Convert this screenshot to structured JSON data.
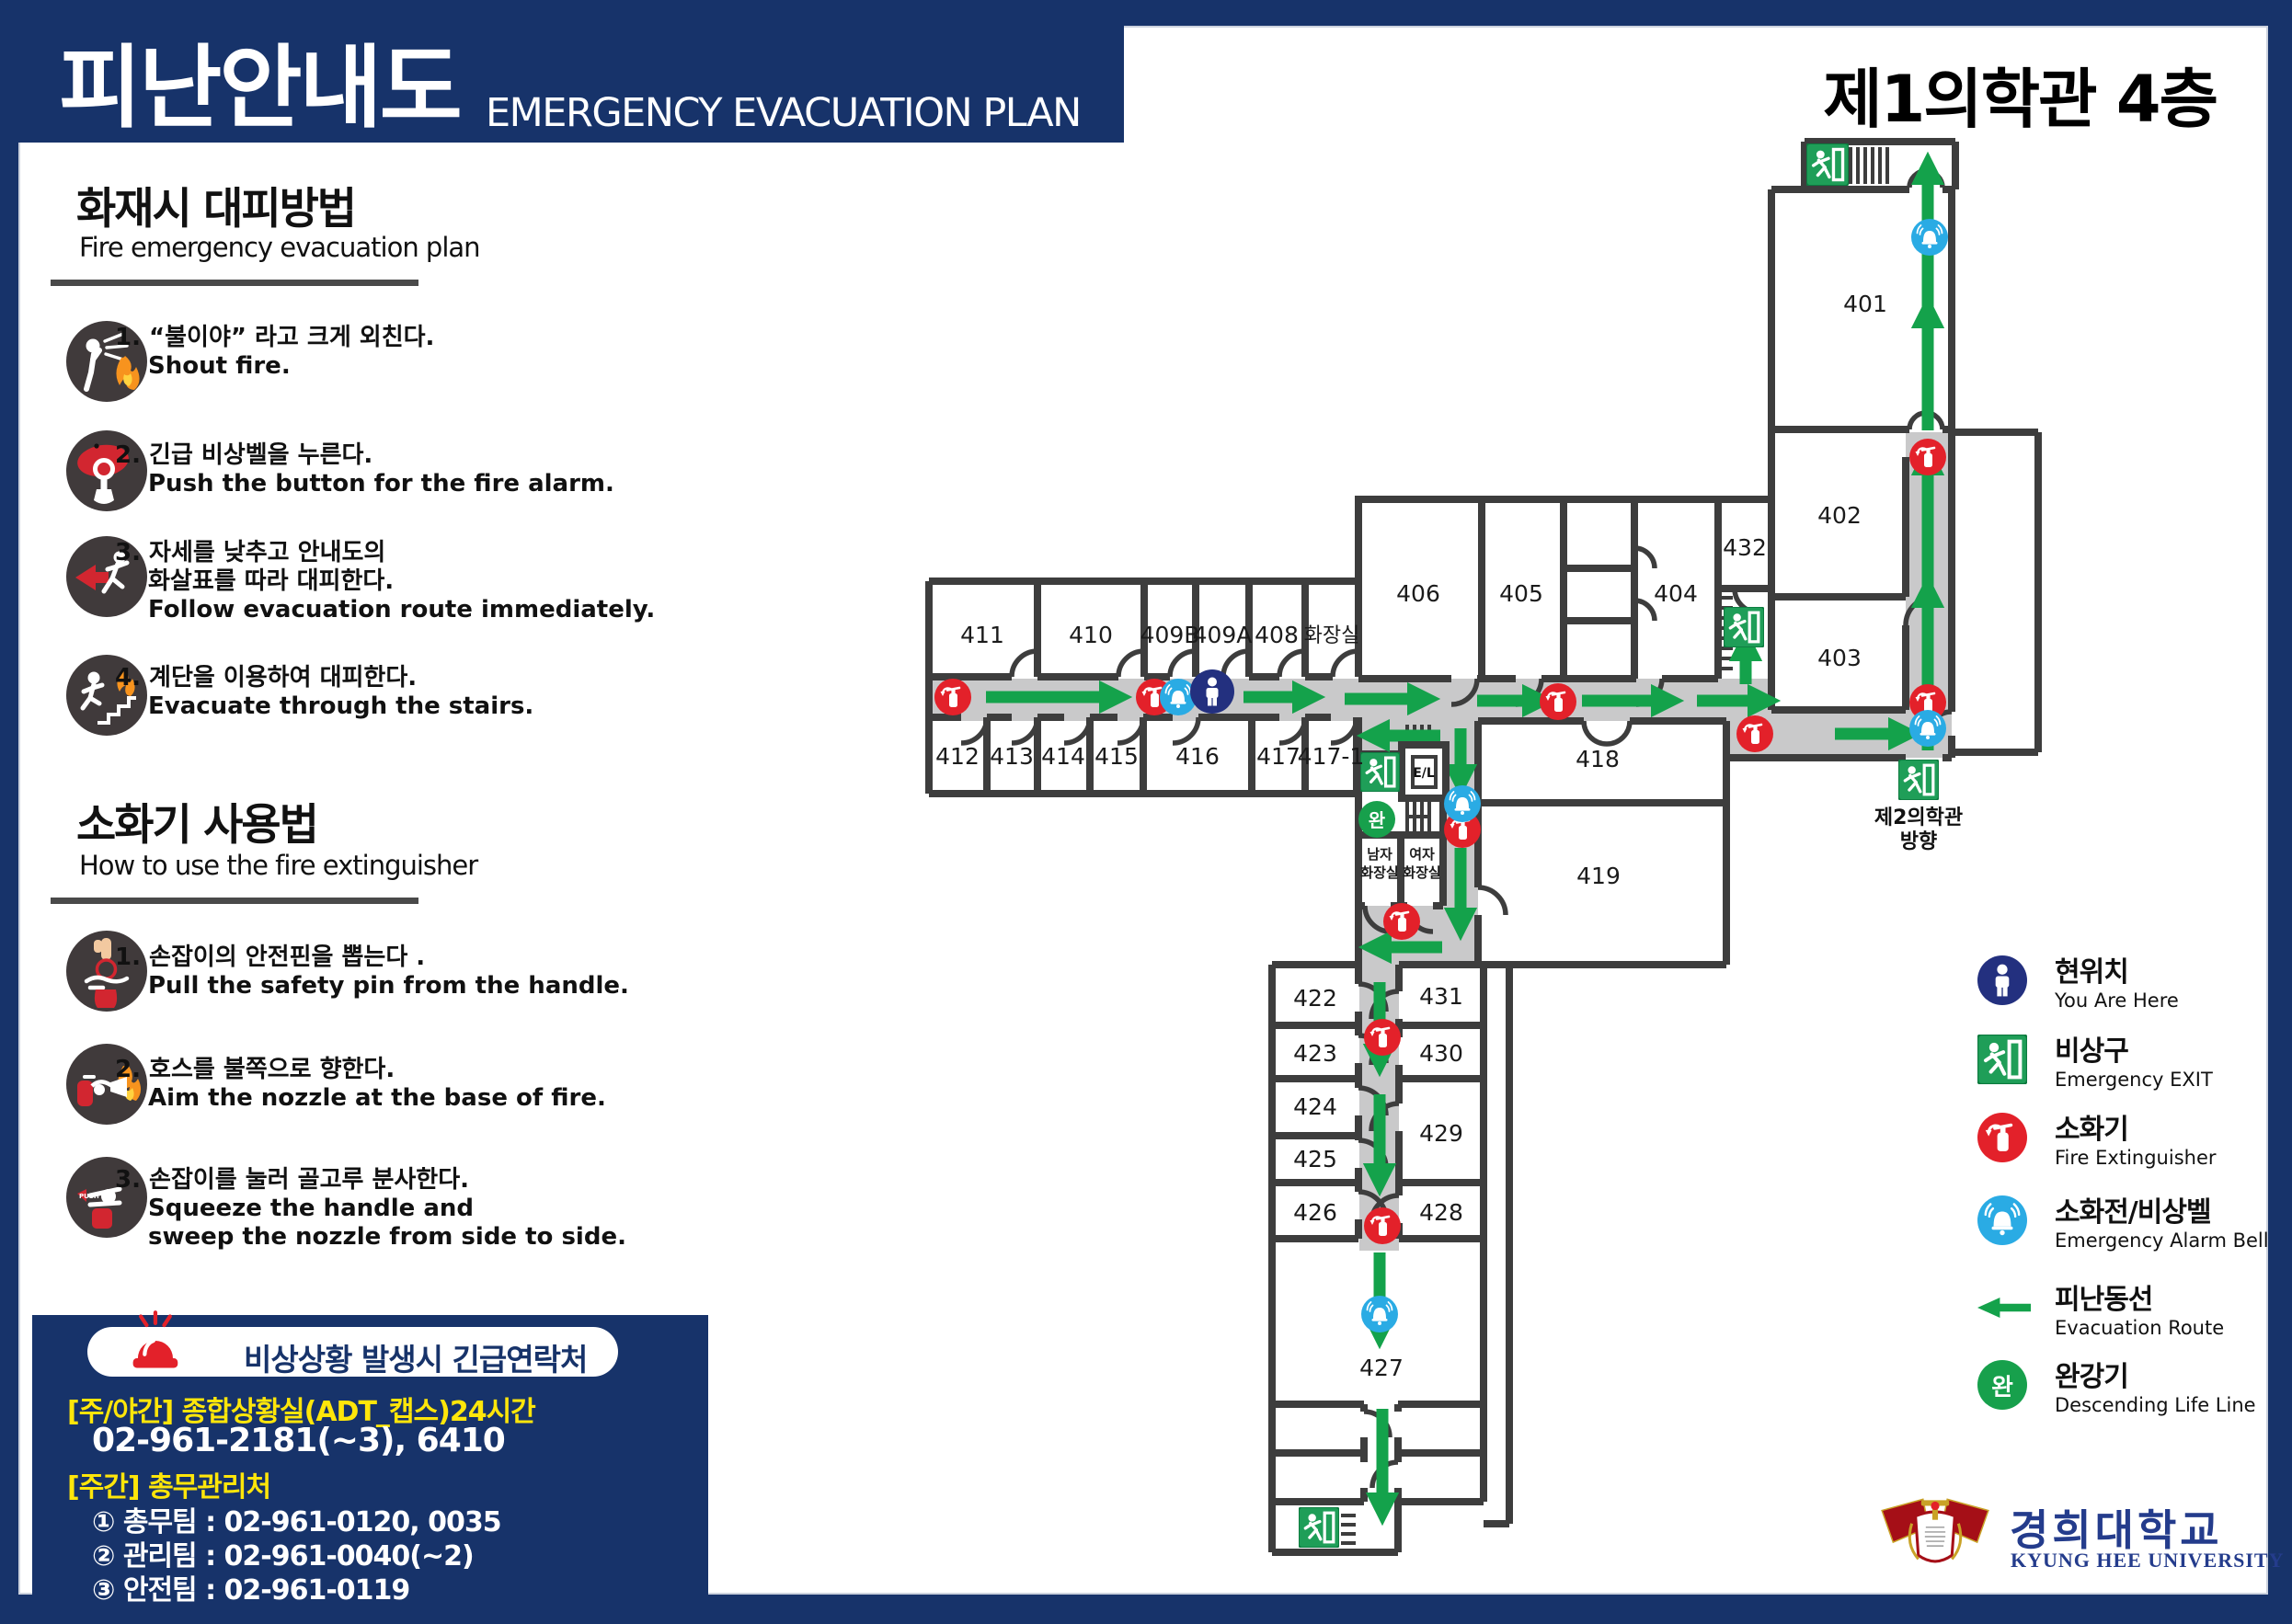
{
  "header": {
    "title_ko": "피난안내도",
    "title_en": "EMERGENCY EVACUATION PLAN"
  },
  "plan_title": "제1의학관 4층",
  "sidebar": {
    "fire": {
      "title": "화재시 대피방법",
      "subtitle": "Fire emergency evacuation plan",
      "steps": [
        {
          "ko": "1. “불이야” 라고 크게 외친다.",
          "en": "Shout fire."
        },
        {
          "ko": "2. 긴급 비상벨을 누른다.",
          "en": "Push the button for the fire alarm."
        },
        {
          "ko": "3. 자세를 낮추고 안내도의\n화살표를 따라 대피한다.",
          "en": "Follow evacuation route immediately."
        },
        {
          "ko": "4. 계단을 이용하여 대피한다.",
          "en": "Evacuate through the stairs."
        }
      ]
    },
    "ext": {
      "title": "소화기 사용법",
      "subtitle": "How to use the fire extinguisher",
      "steps": [
        {
          "ko": "1. 손잡이의 안전핀을 뽑는다 .",
          "en": "Pull the safety pin from the handle."
        },
        {
          "ko": "2. 호스를 불쪽으로 향한다.",
          "en": "Aim the nozzle at the base of fire."
        },
        {
          "ko": "3. 손잡이를 눌러 골고루 분사한다.",
          "en": "Squeeze the handle and\nsweep the nozzle from side to side."
        }
      ]
    }
  },
  "contact": {
    "title": "비상상황 발생시 긴급연락처",
    "lines": [
      "[주/야간] 종합상황실(ADT_캡스)24시간",
      "02-961-2181(~3), 6410",
      "[주간] 총무관리처",
      "① 총무팀 : 02-961-0120, 0035",
      "② 관리팀 : 02-961-0040(~2)",
      "③ 안전팀 : 02-961-0119"
    ]
  },
  "legend": {
    "items": [
      {
        "ko": "현위치",
        "en": "You Are Here"
      },
      {
        "ko": "비상구",
        "en": "Emergency EXIT"
      },
      {
        "ko": "소화기",
        "en": "Fire Extinguisher"
      },
      {
        "ko": "소화전/비상벨",
        "en": "Emergency Alarm Bell"
      },
      {
        "ko": "피난동선",
        "en": "Evacuation Route"
      },
      {
        "ko": "완강기",
        "en": "Descending Life Line"
      }
    ]
  },
  "map": {
    "rooms": {
      "401": "401",
      "402": "402",
      "403": "403",
      "404": "404",
      "405": "405",
      "406": "406",
      "408": "408",
      "409A": "409A",
      "409B": "409B",
      "410": "410",
      "411": "411",
      "412": "412",
      "413": "413",
      "414": "414",
      "415": "415",
      "416": "416",
      "417": "417",
      "417_1": "417-1",
      "418": "418",
      "419": "419",
      "422": "422",
      "423": "423",
      "424": "424",
      "425": "425",
      "426": "426",
      "427": "427",
      "428": "428",
      "429": "429",
      "430": "430",
      "431": "431",
      "432": "432"
    },
    "labels": {
      "toilet": "화장실",
      "men_1": "남자",
      "men_2": "화장실",
      "women_1": "여자",
      "women_2": "화장실",
      "el": "E/L",
      "wan": "완",
      "dir_1": "제2의학관",
      "dir_2": "방향"
    }
  },
  "logo": {
    "ko": "경희대학교",
    "en": "KYUNG HEE UNIVERSITY"
  },
  "colors": {
    "navy": "#17336a",
    "wall": "#3d3d3d",
    "corridor": "#c9c9ca",
    "green": "#14a24b",
    "exit_green": "#1f9e58",
    "red": "#e3212a",
    "blue": "#2aabe4",
    "here_navy": "#23307f",
    "wan_green": "#17a04c",
    "yellow": "#ffe60a"
  }
}
